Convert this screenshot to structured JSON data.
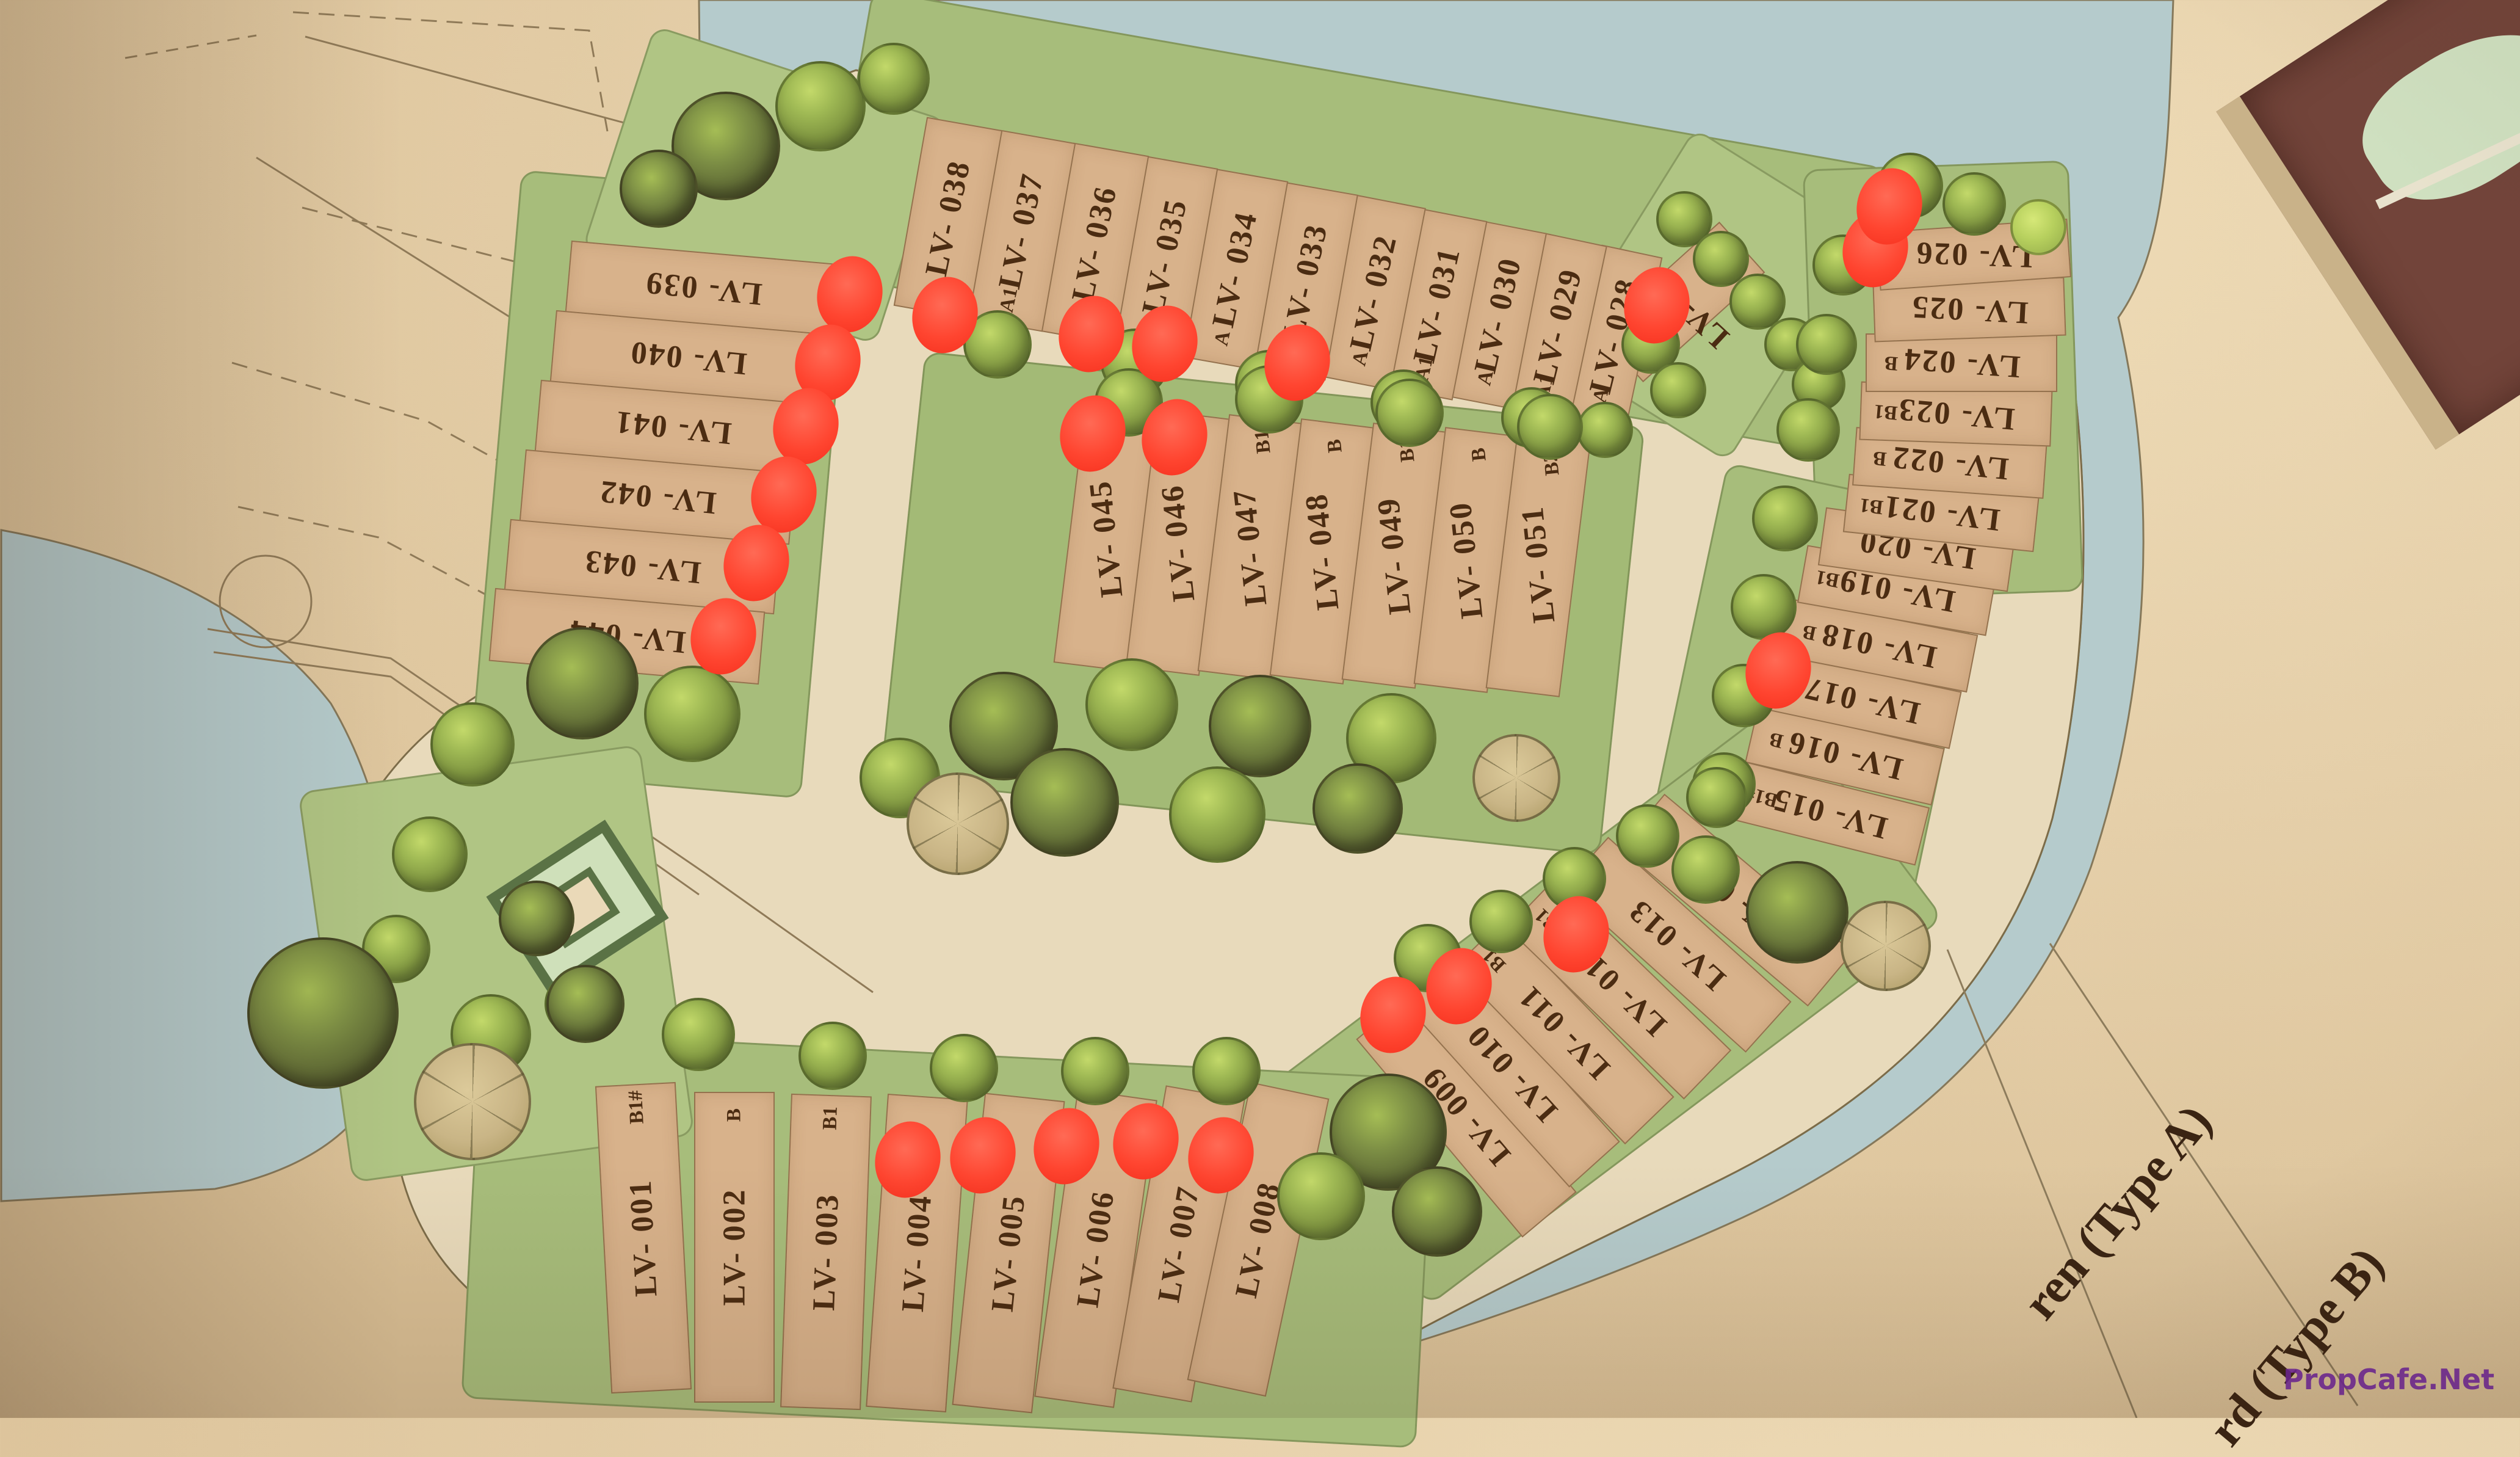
{
  "map": {
    "title_hidden": "",
    "lots": [
      {
        "id": "LV- 001",
        "type": "B1#",
        "sold": false
      },
      {
        "id": "LV- 002",
        "type": "B",
        "sold": false
      },
      {
        "id": "LV- 003",
        "type": "B1",
        "sold": false
      },
      {
        "id": "LV- 004",
        "type": "",
        "sold": true
      },
      {
        "id": "LV- 005",
        "type": "",
        "sold": true
      },
      {
        "id": "LV- 006",
        "type": "",
        "sold": true
      },
      {
        "id": "LV- 007",
        "type": "",
        "sold": true
      },
      {
        "id": "LV- 008",
        "type": "",
        "sold": true
      },
      {
        "id": "LV- 009",
        "type": "",
        "sold": true
      },
      {
        "id": "LV- 010",
        "type": "",
        "sold": true
      },
      {
        "id": "LV- 011",
        "type": "B1",
        "sold": false
      },
      {
        "id": "LV- 012",
        "type": "B1",
        "sold": true
      },
      {
        "id": "LV- 013",
        "type": "",
        "sold": false
      },
      {
        "id": "LV- 014",
        "type": "B#",
        "sold": false
      },
      {
        "id": "LV- 015",
        "type": "B1#",
        "sold": false
      },
      {
        "id": "LV- 016",
        "type": "B",
        "sold": false
      },
      {
        "id": "LV- 017",
        "type": "",
        "sold": true
      },
      {
        "id": "LV- 018",
        "type": "B",
        "sold": false
      },
      {
        "id": "LV- 019",
        "type": "B1",
        "sold": false
      },
      {
        "id": "LV- 020",
        "type": "",
        "sold": false
      },
      {
        "id": "LV- 021",
        "type": "B1",
        "sold": false
      },
      {
        "id": "LV- 022",
        "type": "B",
        "sold": false
      },
      {
        "id": "LV- 023",
        "type": "B1",
        "sold": false
      },
      {
        "id": "LV- 024",
        "type": "B",
        "sold": false
      },
      {
        "id": "LV- 025",
        "type": "",
        "sold": true
      },
      {
        "id": "LV- 026",
        "type": "",
        "sold": true
      },
      {
        "id": "LV- 027",
        "type": "",
        "sold": true
      },
      {
        "id": "LV- 028",
        "type": "A",
        "sold": false
      },
      {
        "id": "LV- 029",
        "type": "A1",
        "sold": false
      },
      {
        "id": "LV- 030",
        "type": "A",
        "sold": false
      },
      {
        "id": "LV- 031",
        "type": "A1",
        "sold": false
      },
      {
        "id": "LV- 032",
        "type": "A",
        "sold": false
      },
      {
        "id": "LV- 033",
        "type": "",
        "sold": true
      },
      {
        "id": "LV- 034",
        "type": "A",
        "sold": false
      },
      {
        "id": "LV- 035",
        "type": "",
        "sold": true
      },
      {
        "id": "LV- 036",
        "type": "",
        "sold": true
      },
      {
        "id": "LV- 037",
        "type": "A1",
        "sold": false
      },
      {
        "id": "LV- 038",
        "type": "",
        "sold": true
      },
      {
        "id": "LV- 039",
        "type": "",
        "sold": true
      },
      {
        "id": "LV- 040",
        "type": "",
        "sold": true
      },
      {
        "id": "LV- 041",
        "type": "",
        "sold": true
      },
      {
        "id": "LV- 042",
        "type": "",
        "sold": true
      },
      {
        "id": "LV- 043",
        "type": "",
        "sold": true
      },
      {
        "id": "LV- 044",
        "type": "",
        "sold": true
      },
      {
        "id": "LV- 045",
        "type": "",
        "sold": true
      },
      {
        "id": "LV- 046",
        "type": "",
        "sold": true
      },
      {
        "id": "LV- 047",
        "type": "B1",
        "sold": false
      },
      {
        "id": "LV- 048",
        "type": "B",
        "sold": false
      },
      {
        "id": "LV- 049",
        "type": "B1",
        "sold": false
      },
      {
        "id": "LV- 050",
        "type": "B",
        "sold": false
      },
      {
        "id": "LV- 051",
        "type": "B2#",
        "sold": false
      }
    ],
    "legend": [
      {
        "label": "ren (Type A)"
      },
      {
        "label": "rd (Type B)"
      }
    ],
    "watermark": "PropCafe.Net",
    "colors": {
      "sold_dot": "#ff4530",
      "water": "#b5cbcc",
      "land": "#a7bd7b",
      "lot": "#d8b28b",
      "road": "#e8dabb",
      "ink": "#4b2c12",
      "watermark": "#7023a0"
    }
  }
}
